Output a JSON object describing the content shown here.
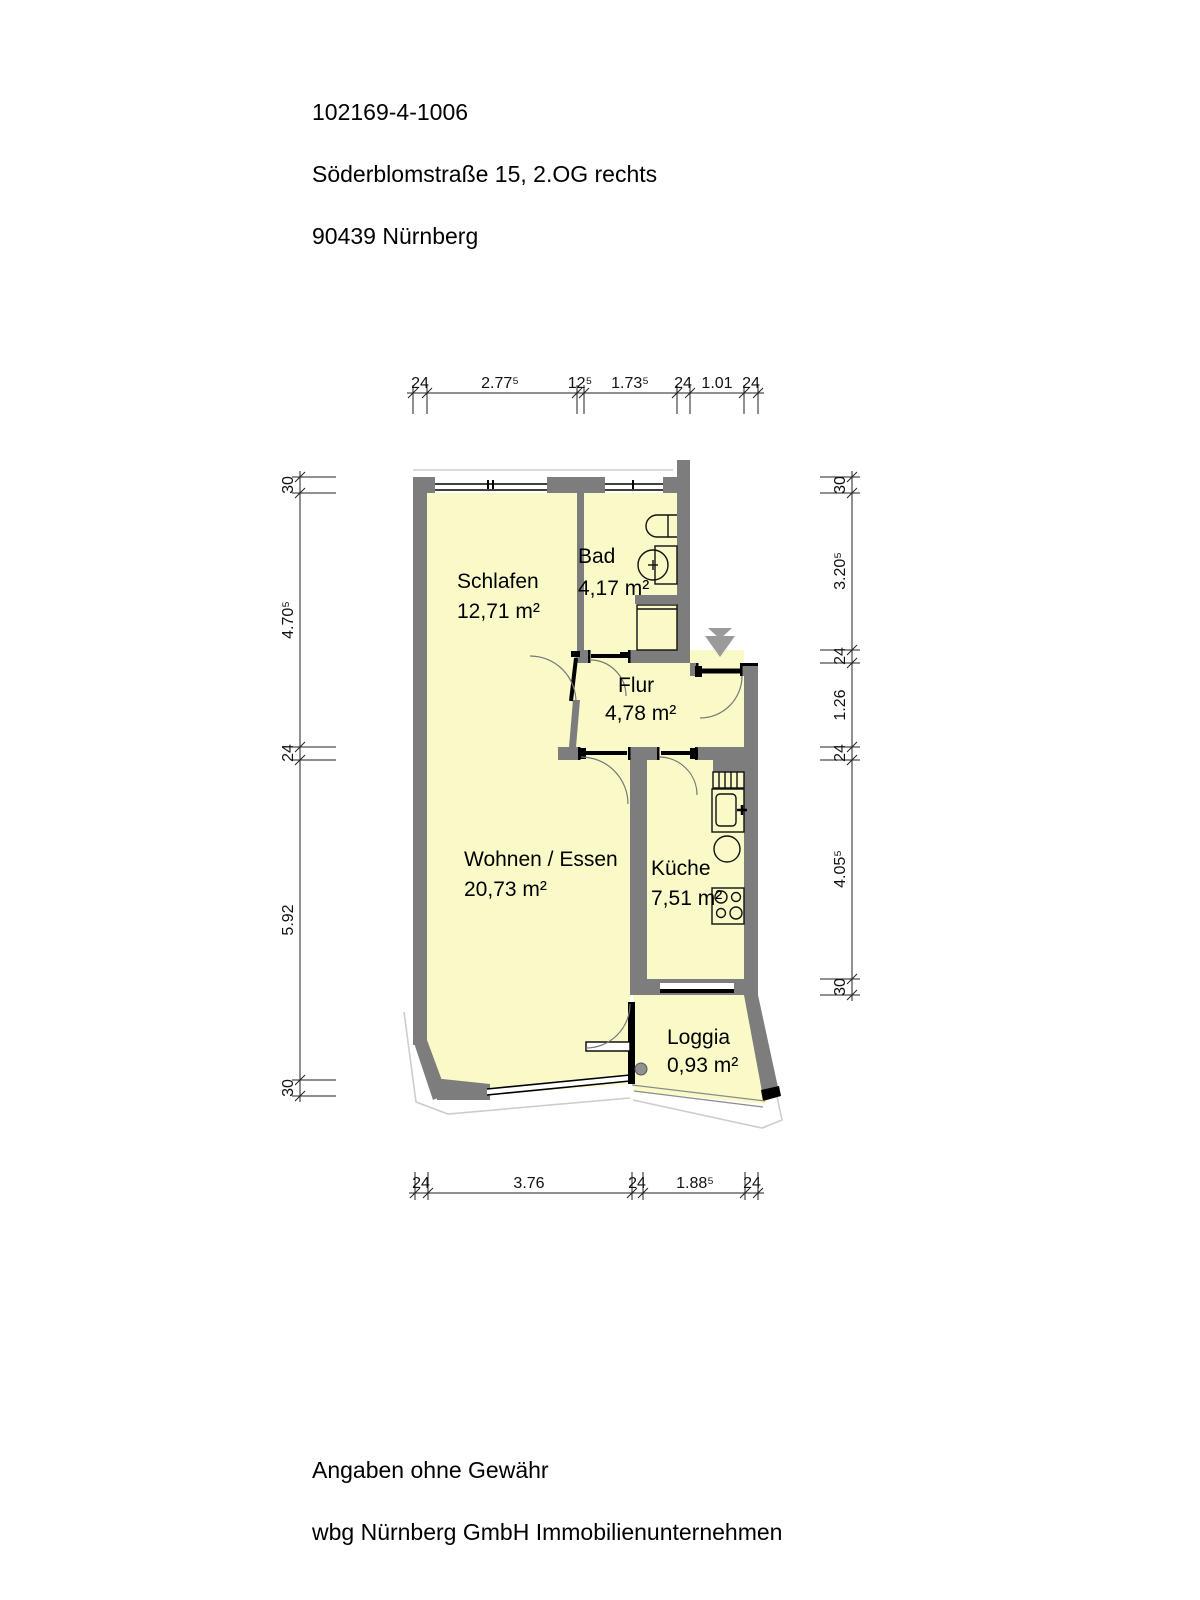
{
  "header": {
    "line1": "102169-4-1006",
    "line2": "Söderblomstraße 15, 2.OG rechts",
    "line3": "90439 Nürnberg"
  },
  "rooms": {
    "schlafen": {
      "name": "Schlafen",
      "area": "12,71 m²"
    },
    "bad": {
      "name": "Bad",
      "area": "4,17 m²"
    },
    "flur": {
      "name": "Flur",
      "area": "4,78 m²"
    },
    "wohnen": {
      "name": "Wohnen / Essen",
      "area": "20,73 m²"
    },
    "kueche": {
      "name": "Küche",
      "area": "7,51 m²"
    },
    "loggia": {
      "name": "Loggia",
      "area": "0,93 m²"
    }
  },
  "dimensions": {
    "top": [
      "24",
      "2.77⁵",
      "12⁵",
      "1.73⁵",
      "24",
      "1.01",
      "24"
    ],
    "left": [
      "30",
      "4.70⁵",
      "24",
      "5.92",
      "30"
    ],
    "right": [
      "30",
      "3.20⁵",
      "24",
      "1.26",
      "24",
      "4.05⁵",
      "30"
    ],
    "bottom": [
      "24",
      "3.76",
      "24",
      "1.88⁵",
      "24"
    ]
  },
  "footer": {
    "line1": "Angaben ohne Gewähr",
    "line2": "wbg Nürnberg GmbH Immobilienunternehmen"
  },
  "icons": [
    "stair-direction-arrow",
    "wc",
    "washbasin",
    "shower",
    "radiator",
    "kitchen-sink",
    "kitchen-basin",
    "stove"
  ],
  "colors": {
    "wall": "#7d7d7d",
    "room_fill": "#fafac8",
    "building_outline": "#cdcdcd",
    "stair_arrow": "#9a9a9a",
    "dimension_text": "#111111"
  }
}
